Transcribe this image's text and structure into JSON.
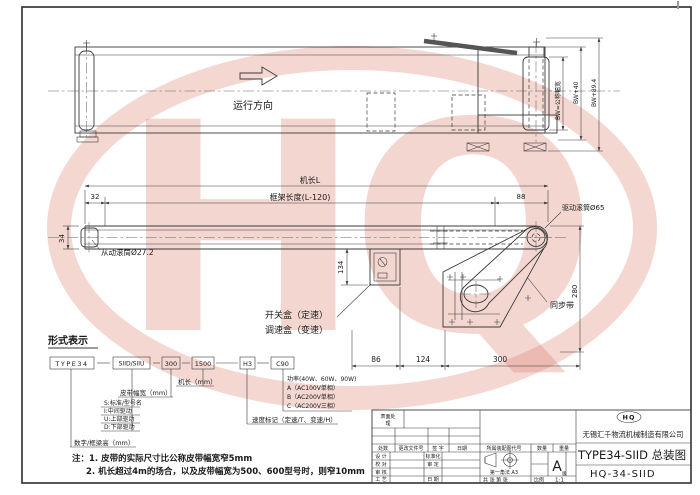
{
  "colors": {
    "line": "#3a3a3a",
    "watermark": "#dc7a66"
  },
  "watermark": {
    "text": "HQ"
  },
  "side_view": {
    "direction_label": "运行方向",
    "dim_bw": "BW=公称幅宽",
    "dim_bw40": "BW+40",
    "dim_bw894": "BW+89.4"
  },
  "plan_view": {
    "dim_machine_length": "机长L",
    "dim_frame_length": "框架长度(L-120)",
    "dim_32": "32",
    "dim_34": "34",
    "dim_88": "88",
    "dim_280": "280",
    "dim_134": "134",
    "dim_86": "86",
    "dim_124": "124",
    "dim_300": "300",
    "label_driven_roller": "从动滚筒Ø27.2",
    "label_drive_roller": "驱动滚筒Ø65",
    "label_sync_belt": "同步带",
    "label_switch_box": "开关盒（定速）",
    "label_speed_box": "调速盒（变速）"
  },
  "designation": {
    "title": "形式表示",
    "boxes": [
      "TYPE34",
      "SIID/SIIU",
      "300",
      "1500",
      "H3",
      "C90"
    ],
    "label_machine_length": "机长（mm）",
    "label_belt_width": "皮带幅宽（mm）",
    "drive_codes": [
      "S:标准/型号名",
      "I:中间驱动",
      "U:上部驱动",
      "D:下部驱动"
    ],
    "label_frame_height": "数字/框梁高（mm）",
    "power_lines": [
      "功率(40W、60W、90W)",
      "A（AC100V单相）",
      "B（AC200V单相）",
      "C（AC200V三相）"
    ],
    "label_speed_mark": "速度标记（定速/T、变速/H）"
  },
  "notes": {
    "line1": "注：1. 皮带的实际尺寸比公称皮带幅宽窄5mm",
    "line2": "2. 机长超过4m的场合，以及皮带幅宽为500、600型号时，则窄10mm"
  },
  "title_block": {
    "surface_treatment_l1": "表面处",
    "surface_treatment_l2": "理",
    "header_cols": [
      "处数",
      "更改文件号",
      "签 字",
      "日期"
    ],
    "rows_left": [
      "设 计",
      "校 对",
      "审 核",
      "工 艺"
    ],
    "rows_right": [
      "标准化",
      "审 定",
      "",
      "日 期"
    ],
    "assembly_code_label": "所属装配图代号",
    "projection_label": "第一角法  A3",
    "sheet_label": "共   张  第   张",
    "scale_label": "比例",
    "scale": "1:1",
    "qty_label": "数量",
    "weight_label": "重量",
    "rev": "A",
    "rev_suffix": "版",
    "logo_text": "HQ",
    "company": "无锡汇千物流机械制造有限公司",
    "title": "TYPE34-SIID 总装图",
    "drawing_no": "HQ-34-SIID"
  }
}
